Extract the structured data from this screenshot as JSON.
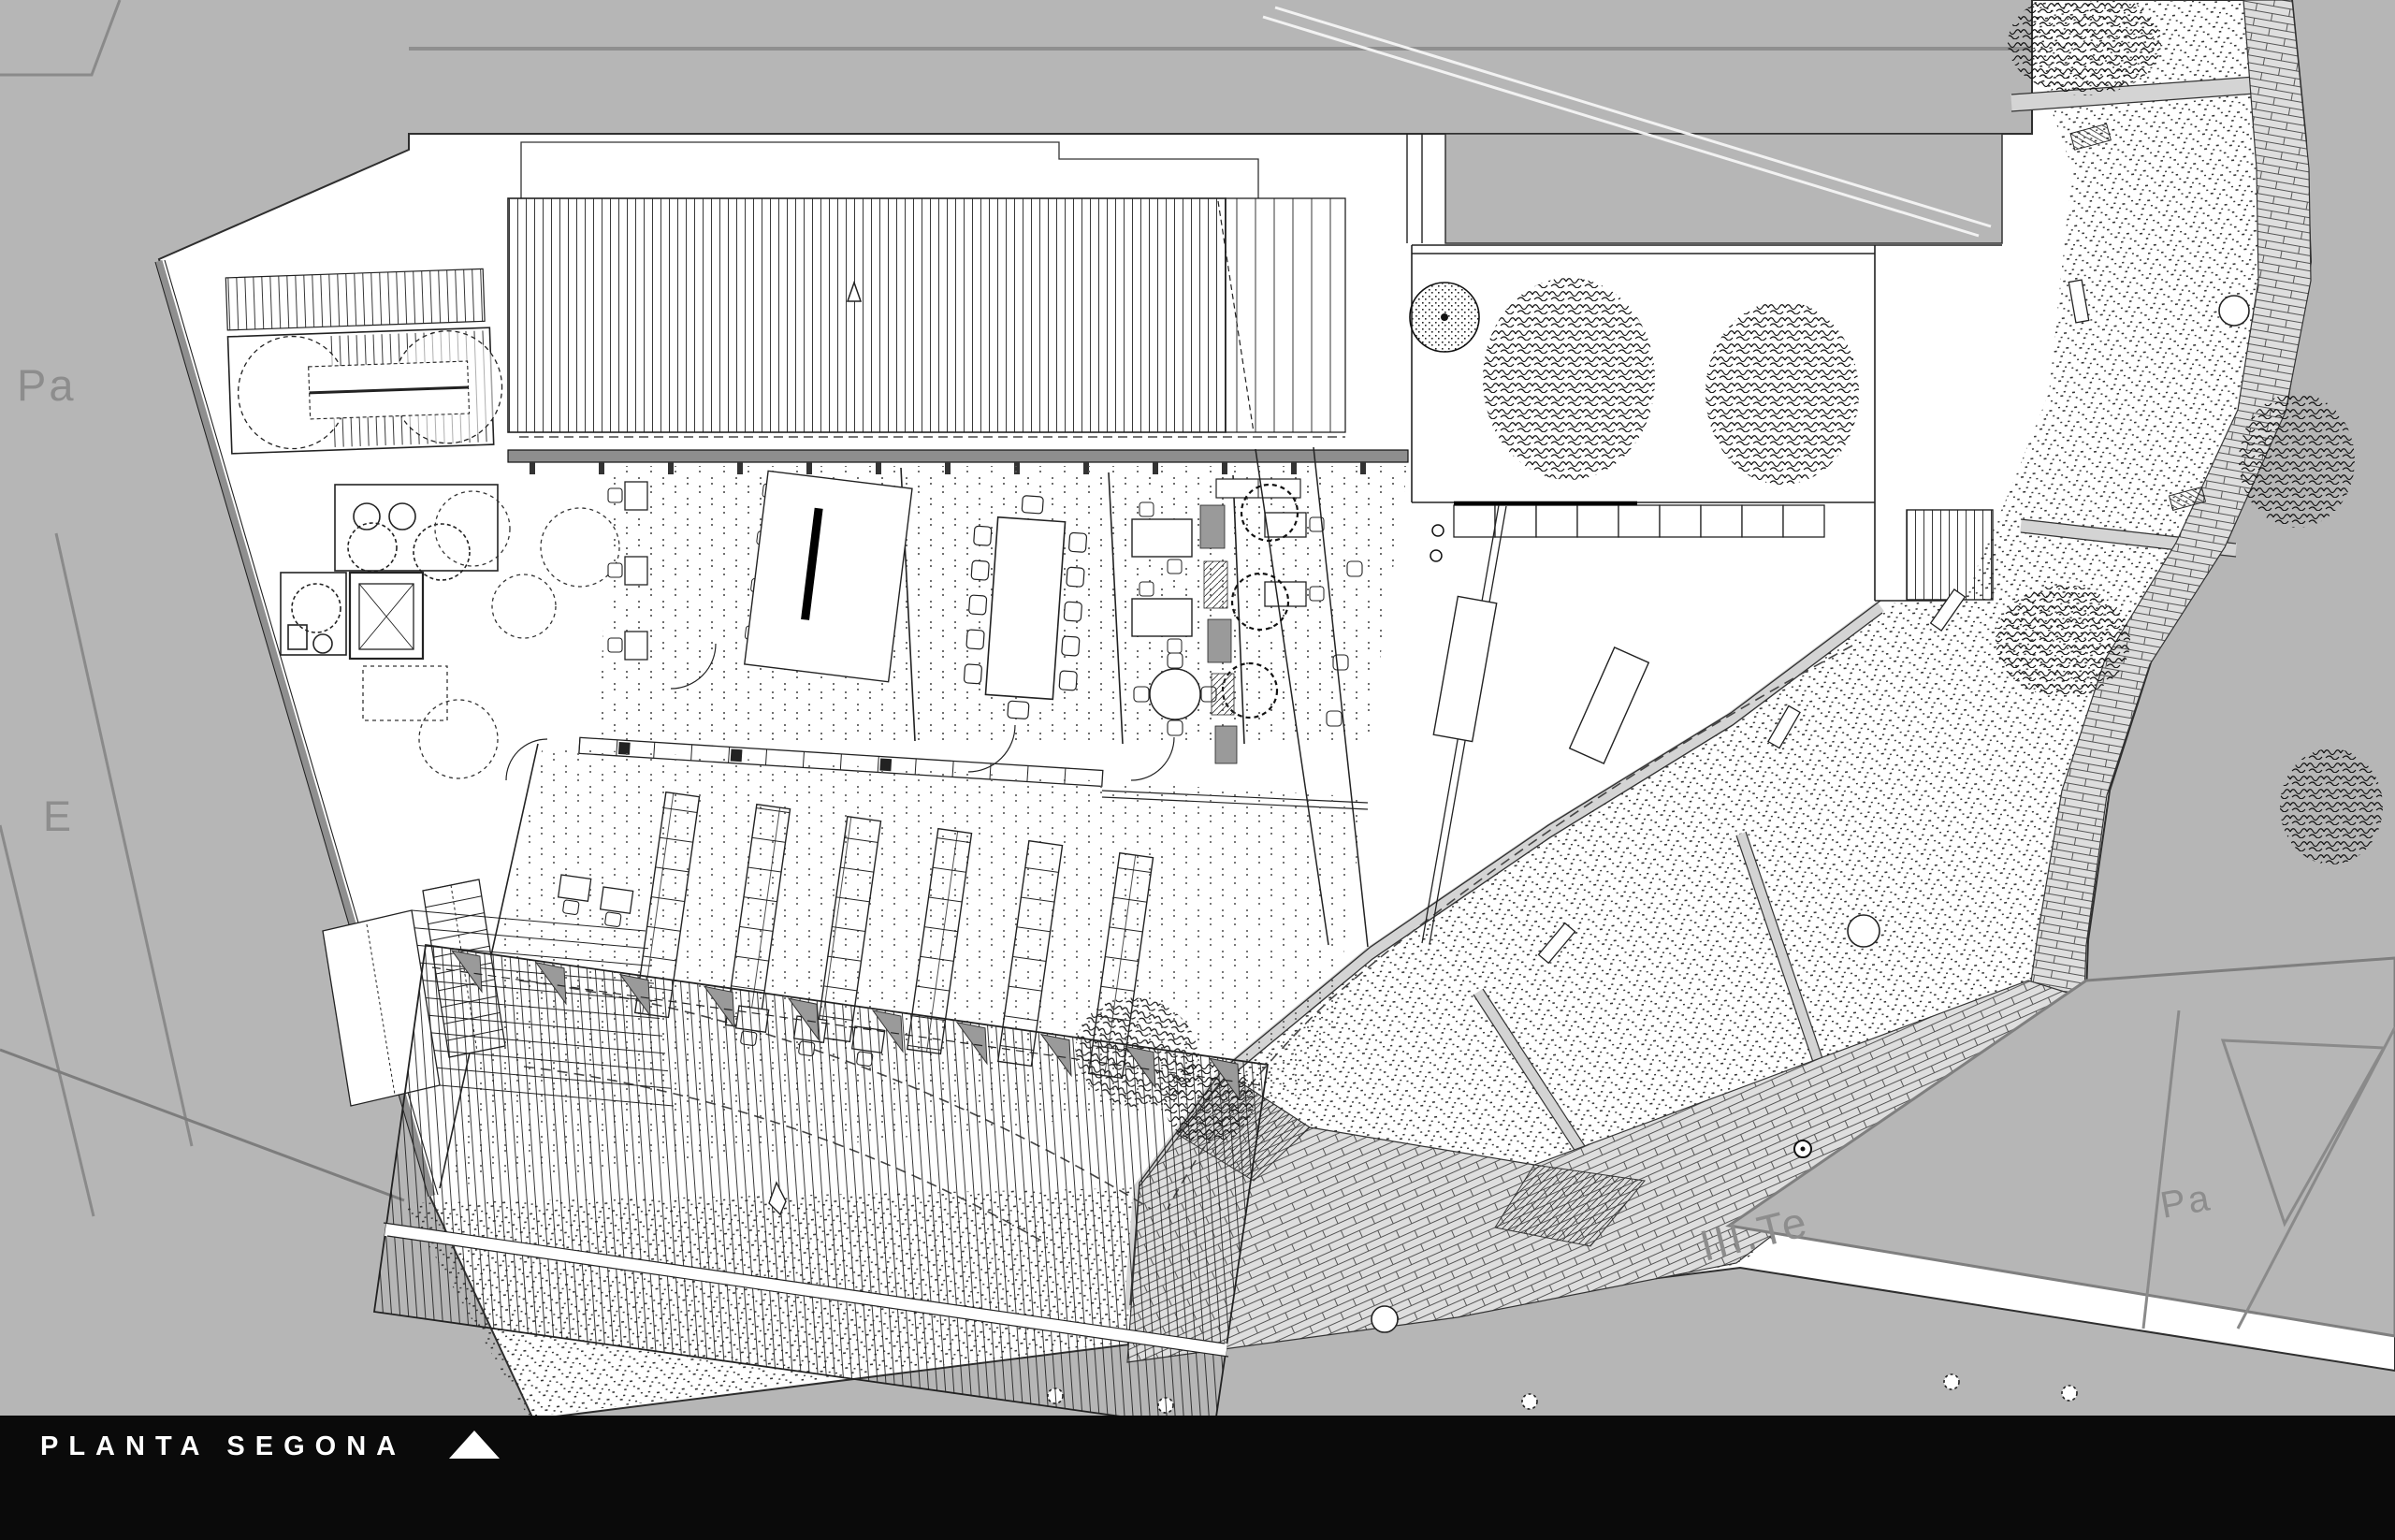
{
  "drawing": {
    "title_bar": {
      "title": "PLANTA SEGONA",
      "north_icon": "triangle-up",
      "bg": "#0a0a0a",
      "fg": "#ffffff"
    },
    "labels": {
      "parcel_top_left": "Pa",
      "block_left": "E",
      "street": "III.Te",
      "parcel_bottom_right": "Pa"
    },
    "palette": {
      "background": "#b6b6b6",
      "paper": "#ffffff",
      "ink": "#1f1f1f",
      "wall_gray": "#8e8e8e",
      "paver_gray": "#d4d4d4",
      "sawtooth_gray": "#9a9a9a",
      "label_gray": "#8d8d8d"
    }
  }
}
